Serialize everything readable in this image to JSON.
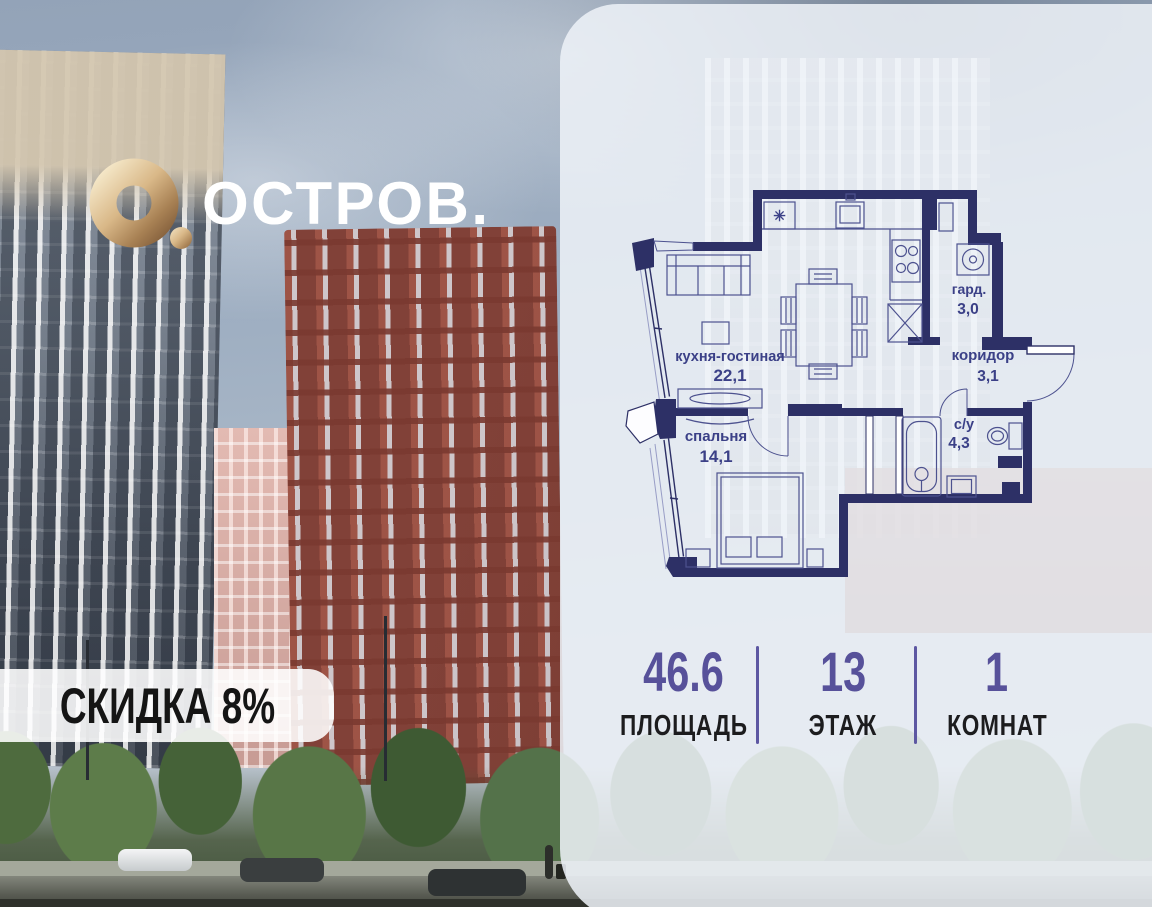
{
  "brand": {
    "logo_text": "ОСТРОВ."
  },
  "discount_badge": {
    "label": "СКИДКА 8%"
  },
  "floor_plan": {
    "kitchen_vent_symbol": "✳",
    "rooms": [
      {
        "name": "кухня-гостиная",
        "area": "22,1"
      },
      {
        "name": "спальня",
        "area": "14,1"
      },
      {
        "name": "гард.",
        "area": "3,0"
      },
      {
        "name": "коридор",
        "area": "3,1"
      },
      {
        "name": "с/у",
        "area": "4,3"
      }
    ]
  },
  "stats": {
    "area": {
      "value": "46.6",
      "label": "ПЛОЩАДЬ"
    },
    "floor": {
      "value": "13",
      "label": "ЭТАЖ"
    },
    "rooms": {
      "value": "1",
      "label": "КОМНАТ"
    }
  },
  "colors": {
    "wall_navy": "#2d3066",
    "accent_purple": "#57519a",
    "logo_gold": "#c9a474",
    "panel_white": "rgba(237,241,247,0.87)"
  }
}
